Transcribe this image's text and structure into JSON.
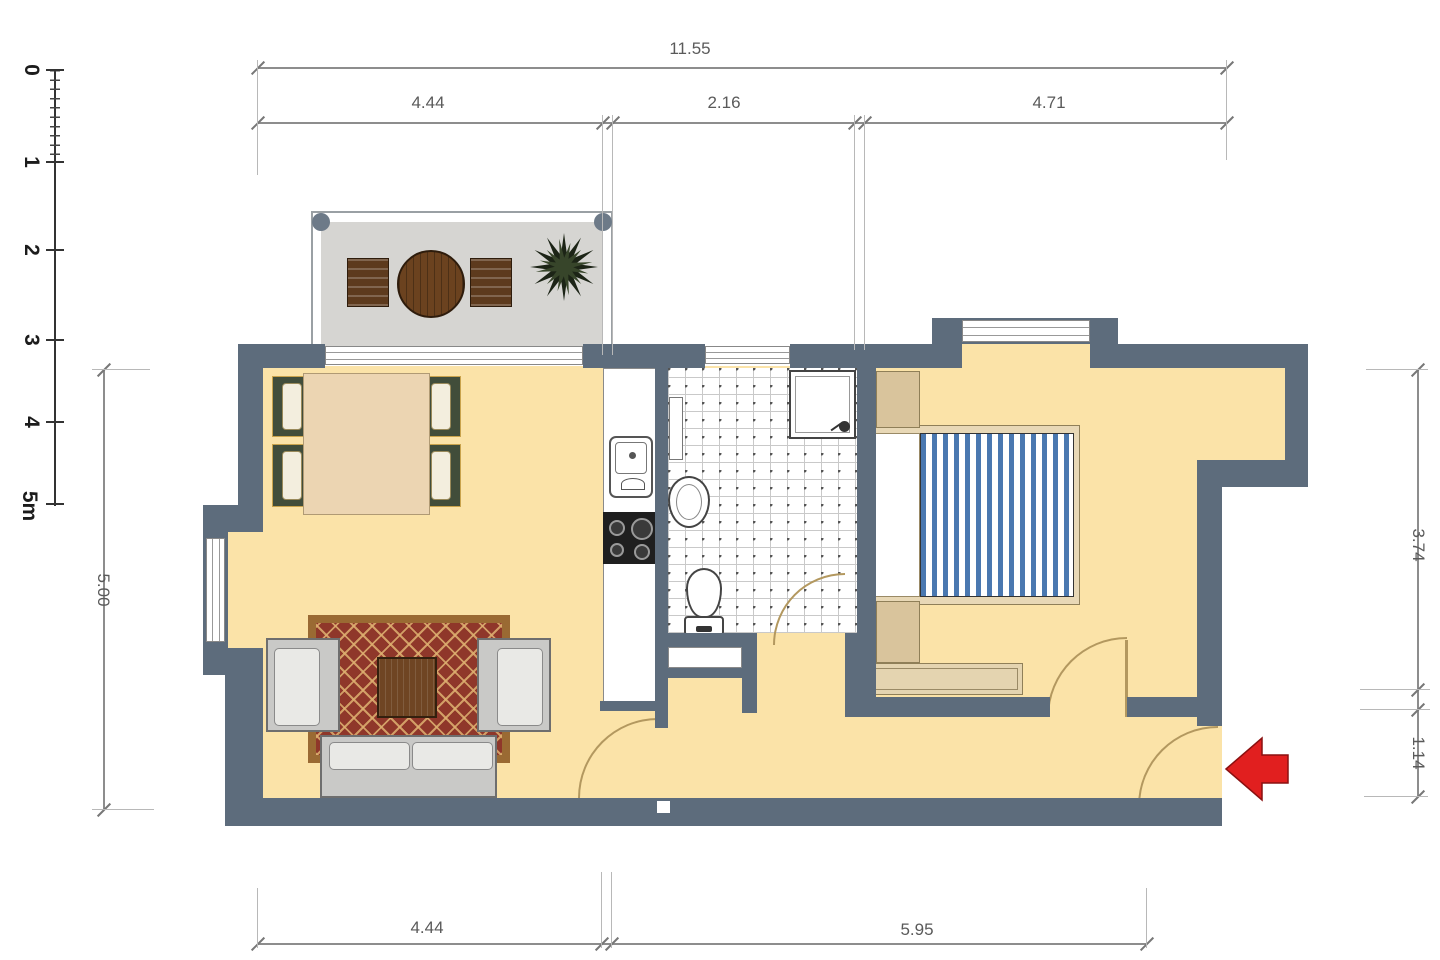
{
  "ruler": {
    "labels": [
      "0",
      "1",
      "2",
      "3",
      "4",
      "5m"
    ]
  },
  "dimensions": {
    "top_total": "11.55",
    "top_segments": [
      "4.44",
      "2.16",
      "4.71"
    ],
    "left_height": "5.00",
    "right_upper": "3.74",
    "right_lower": "1.14",
    "bottom_segments": [
      "4.44",
      "5.95"
    ]
  },
  "colors": {
    "wall": "#5d6c7c",
    "floor": "#fbe3a8",
    "balcony": "#d6d5d2",
    "bedblue": "#4a78b0",
    "rugred": "#8f372a",
    "rugborder": "#9a6a33",
    "wood": "#6f4523",
    "chairgreen": "#414d3a",
    "tan": "#e3d2ae",
    "arrowred": "#e11f1f",
    "dimline": "#8d8d8d",
    "dimtext": "#5a5a5a"
  }
}
